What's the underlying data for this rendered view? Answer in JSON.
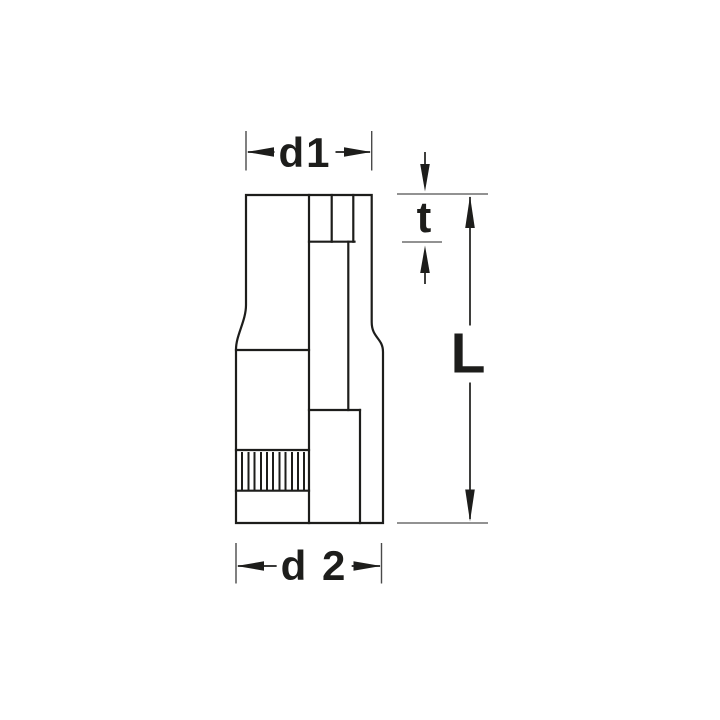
{
  "figure": {
    "kind": "technical-dimension-drawing",
    "subject": "socket side view with partial section"
  },
  "labels": {
    "d1": "d1",
    "t": "t",
    "L": "L",
    "d2": "d 2"
  },
  "colors": {
    "background": "#ffffff",
    "line": "#1d1d1b",
    "reference_line": "#6e6e6e",
    "extension_tick": "#4a4a4a"
  }
}
